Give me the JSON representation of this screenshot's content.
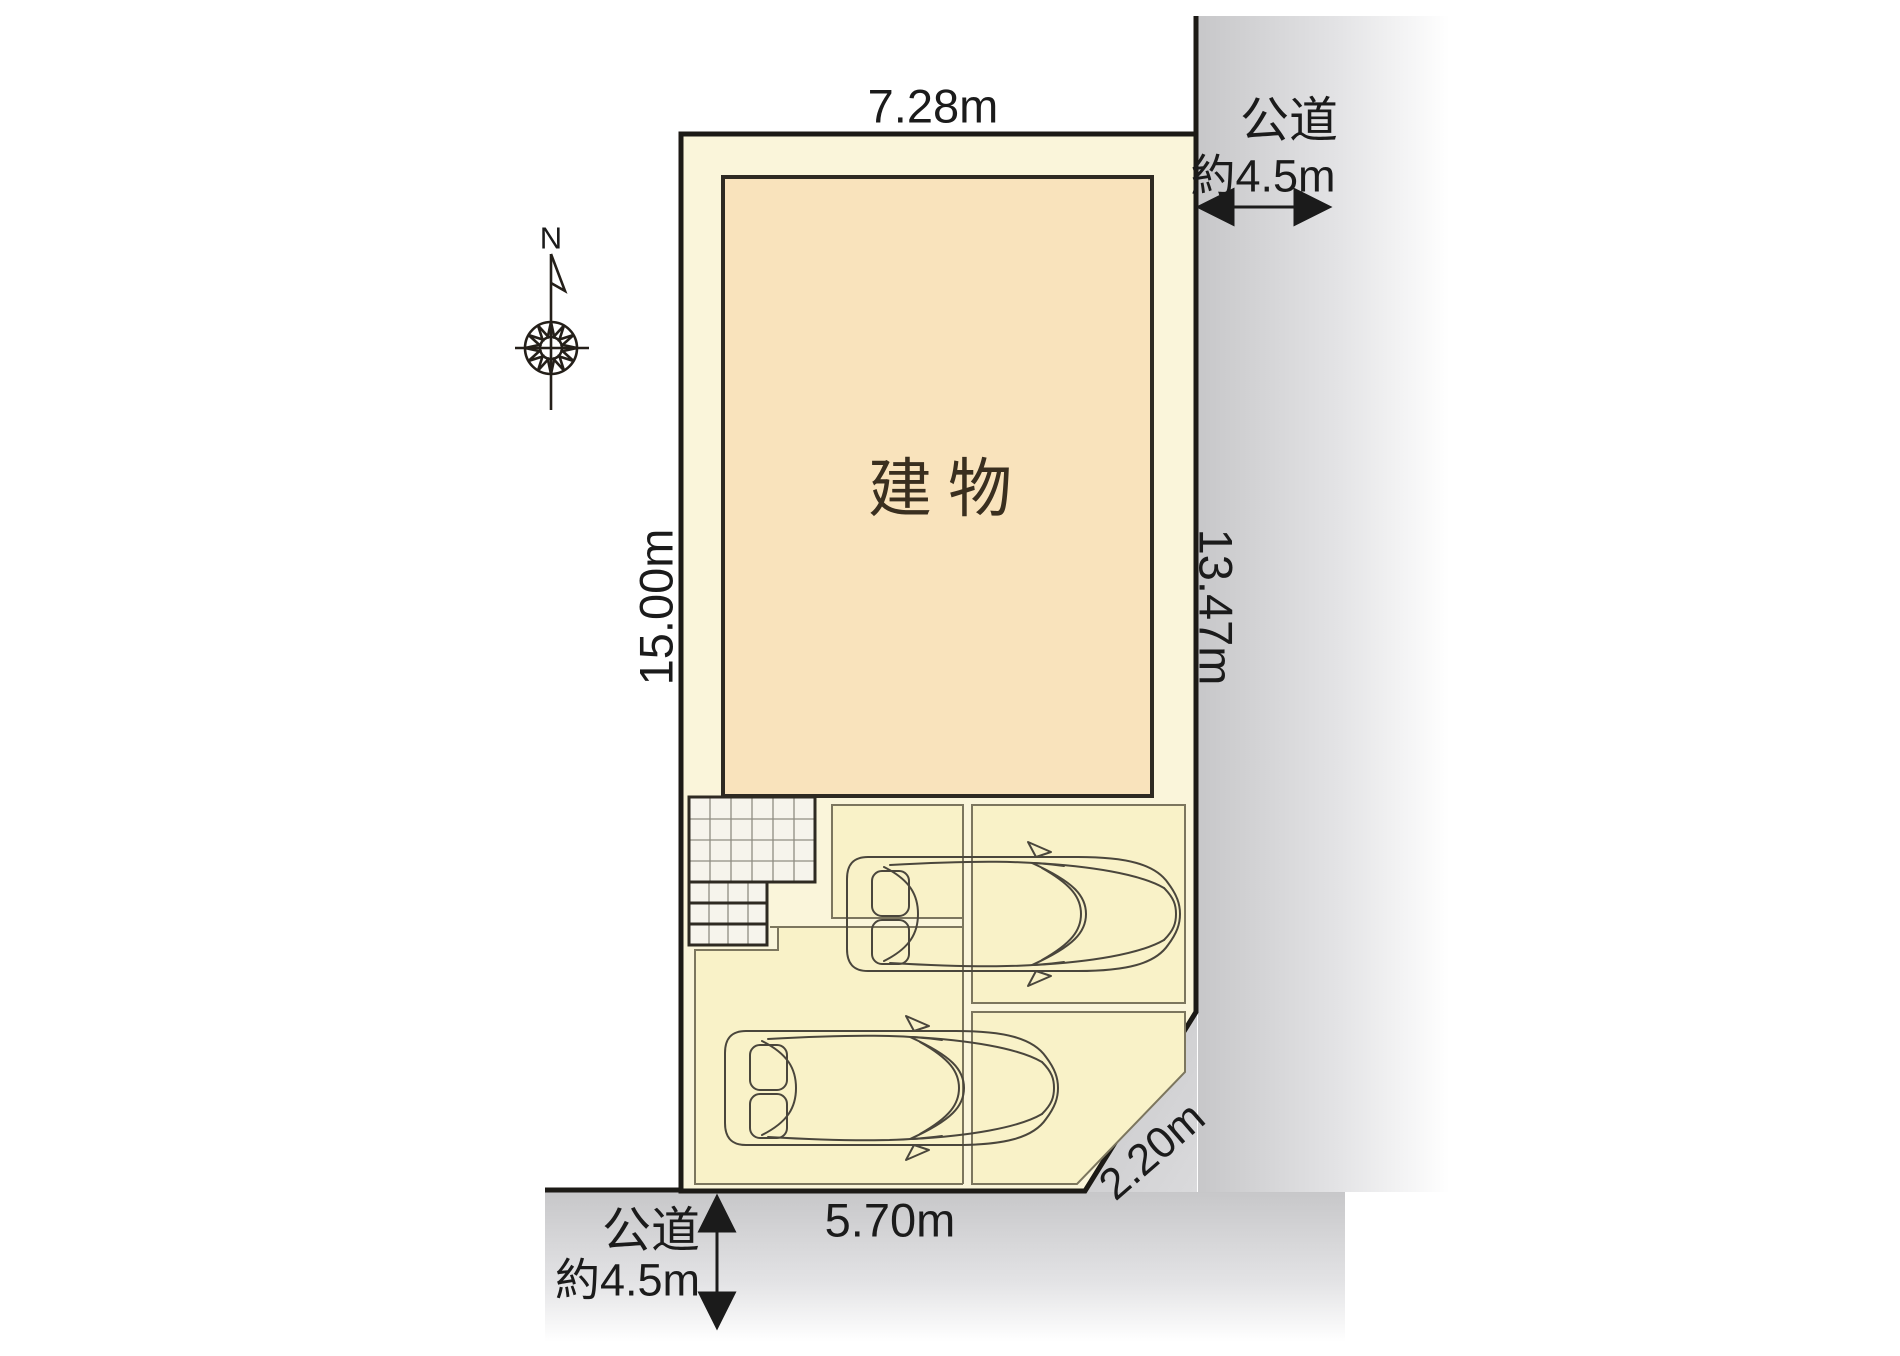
{
  "site_plan": {
    "building": {
      "label": "建物"
    },
    "dimensions": {
      "top": "7.28m",
      "left": "15.00m",
      "right": "13.47m",
      "bottom": "5.70m",
      "corner": "2.20m"
    },
    "roads": {
      "right": {
        "name": "公道",
        "width": "約4.5m"
      },
      "bottom": {
        "name": "公道",
        "width": "約4.5m"
      }
    },
    "compass": {
      "north": "N"
    },
    "colors": {
      "plot_fill": "#FAF5DA",
      "parking_fill": "#F9F2C8",
      "building_fill": "#F9E3BC",
      "tile_fill": "#F6F4EC",
      "car_fill": "#FCFBF3",
      "road_gray": "#C7C7C9",
      "outline": "#1C1A16"
    }
  }
}
